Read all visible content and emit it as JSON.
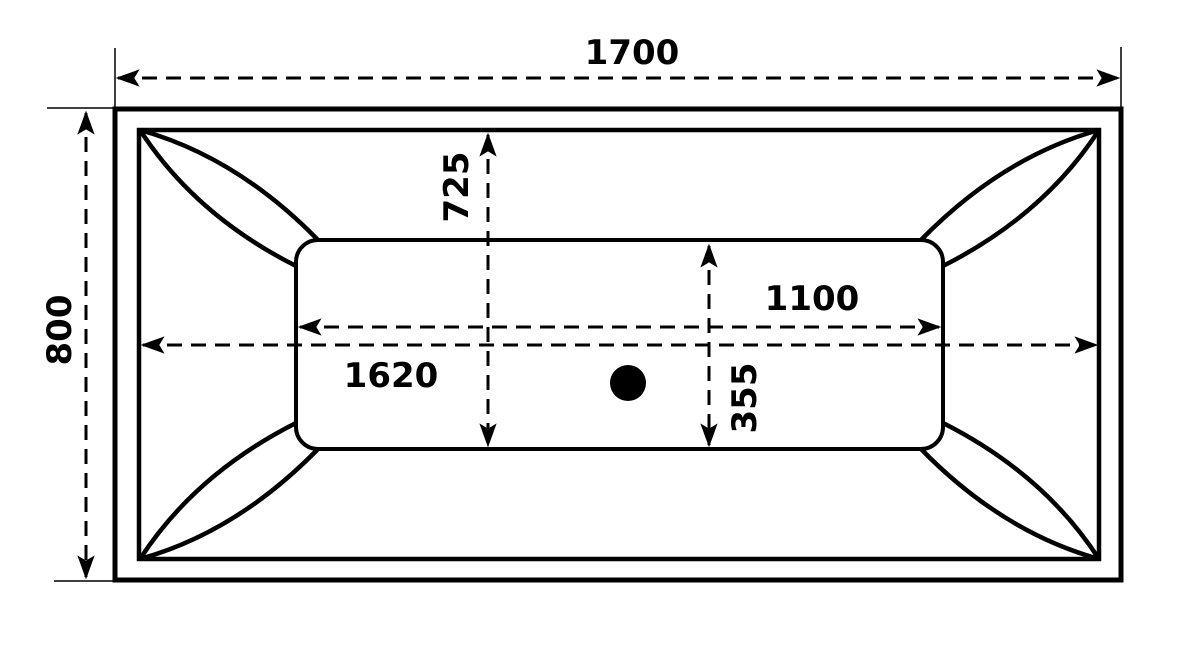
{
  "diagram": {
    "background_color": "#ffffff",
    "line_color": "#000000",
    "labels": {
      "overall_length": "1700",
      "overall_width": "800",
      "rim_inner_length": "1620",
      "rim_inner_width": "725",
      "basin_length": "1100",
      "basin_width": "355"
    }
  }
}
